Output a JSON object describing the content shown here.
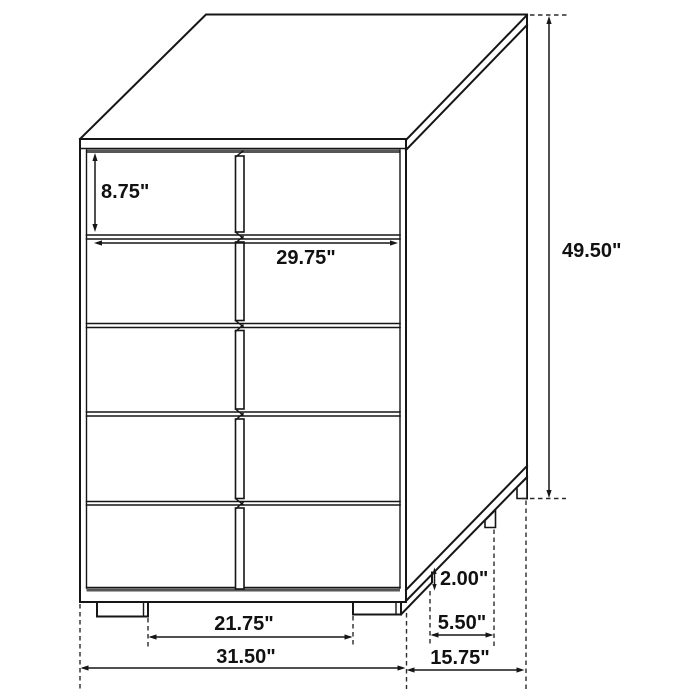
{
  "diagram": {
    "subject": "5-drawer chest",
    "view": "three-quarter line drawing",
    "units": "inches"
  },
  "dimensions": {
    "drawer_height": {
      "label": "8.75\"",
      "value": 8.75
    },
    "drawer_width": {
      "label": "29.75\"",
      "value": 29.75
    },
    "overall_height": {
      "label": "49.50\"",
      "value": 49.5
    },
    "foot_height": {
      "label": "2.00\"",
      "value": 2.0
    },
    "side_foot_spacing": {
      "label": "5.50\"",
      "value": 5.5
    },
    "front_foot_spacing": {
      "label": "21.75\"",
      "value": 21.75
    },
    "overall_width": {
      "label": "31.50\"",
      "value": 31.5
    },
    "overall_depth": {
      "label": "15.75\"",
      "value": 15.75
    }
  },
  "colors": {
    "line": "#161616",
    "shadow_strip": "#565656",
    "dashed_line": "#2b2b2b",
    "background": "#ffffff"
  }
}
